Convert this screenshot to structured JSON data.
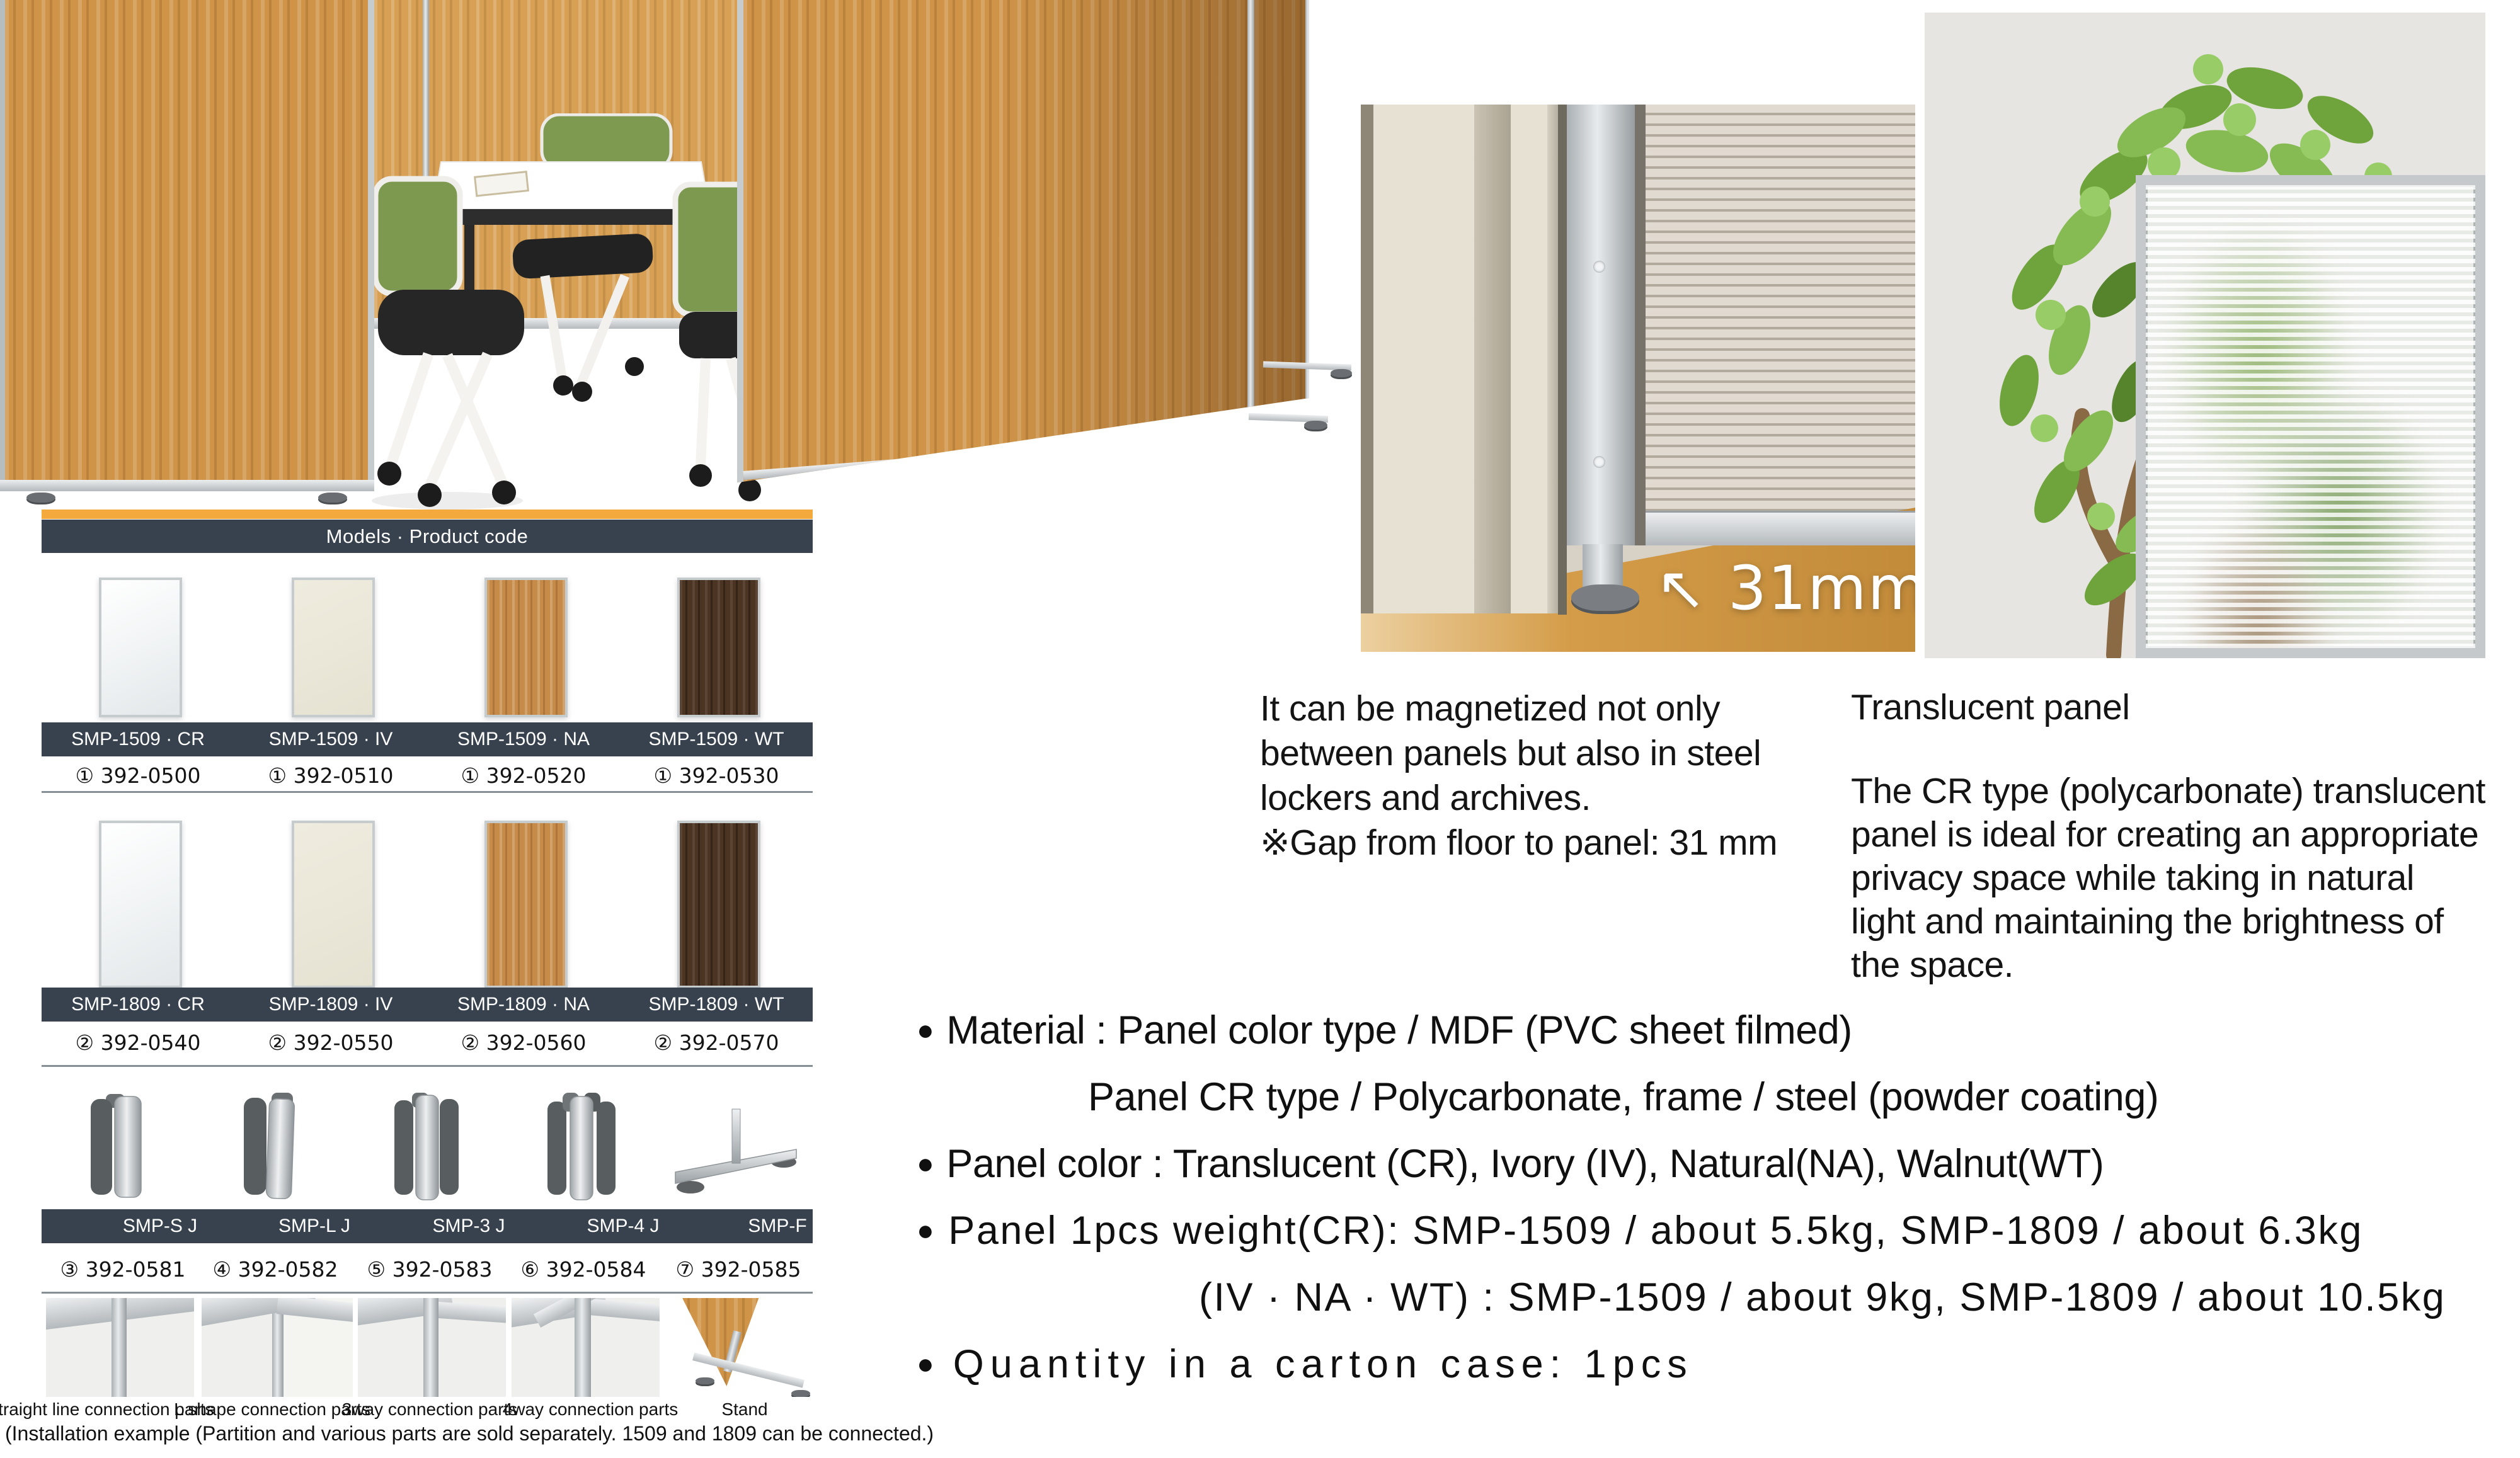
{
  "models_table": {
    "header": "Models · Product code",
    "row1": {
      "models": [
        "SMP-1509 · CR",
        "SMP-1509 · IV",
        "SMP-1509 · NA",
        "SMP-1509 · WT"
      ],
      "codes": [
        "① 392-0500",
        "① 392-0510",
        "① 392-0520",
        "① 392-0530"
      ]
    },
    "row2": {
      "models": [
        "SMP-1809 · CR",
        "SMP-1809 · IV",
        "SMP-1809 · NA",
        "SMP-1809 · WT"
      ],
      "codes": [
        "② 392-0540",
        "② 392-0550",
        "② 392-0560",
        "② 392-0570"
      ]
    },
    "row3": {
      "models": [
        "SMP-S J",
        "SMP-L J",
        "SMP-3 J",
        "SMP-4 J",
        "SMP-F"
      ],
      "codes": [
        "③ 392-0581",
        "④ 392-0582",
        "⑤ 392-0583",
        "⑥ 392-0584",
        "⑦ 392-0585"
      ]
    },
    "example_captions": [
      "Straight line connection parts",
      "L shape connection parts",
      "3way connection parts",
      "4way connection parts",
      "Stand"
    ],
    "footnote": "(Installation example (Partition and various parts are sold separately. 1509 and 1809 can be connected.)"
  },
  "gap_photo": {
    "label": "↖ 31mm"
  },
  "magnet_note": {
    "lines": [
      "It can be magnetized not only",
      "between panels but also in steel",
      "lockers and archives.",
      "※Gap from floor to panel: 31 mm"
    ]
  },
  "translucent": {
    "title": "Translucent panel",
    "lines": [
      "The CR type (polycarbonate) translucent",
      "panel is ideal for creating an appropriate",
      "privacy space while taking in natural",
      "light and maintaining the brightness of",
      "the space."
    ]
  },
  "specs": {
    "lines": [
      {
        "marker": "●",
        "text": "Material : Panel color type / MDF (PVC sheet filmed)"
      },
      {
        "marker": "",
        "text": "Panel CR type / Polycarbonate, frame / steel (powder coating)"
      },
      {
        "marker": "●",
        "text": "Panel color : Translucent (CR), Ivory (IV), Natural(NA), Walnut(WT)"
      },
      {
        "marker": "●",
        "text": "Panel 1pcs weight(CR): SMP-1509 / about 5.5kg,  SMP-1809 / about 6.3kg"
      },
      {
        "marker": "",
        "text": "(IV · NA · WT) : SMP-1509 / about 9kg,  SMP-1809 / about 10.5kg"
      },
      {
        "marker": "●",
        "text": "Quantity in a carton case: 1pcs"
      }
    ]
  },
  "colors": {
    "accent_orange": "#F4A93C",
    "header_navy": "#37424E",
    "divider_gray": "#878F96"
  }
}
